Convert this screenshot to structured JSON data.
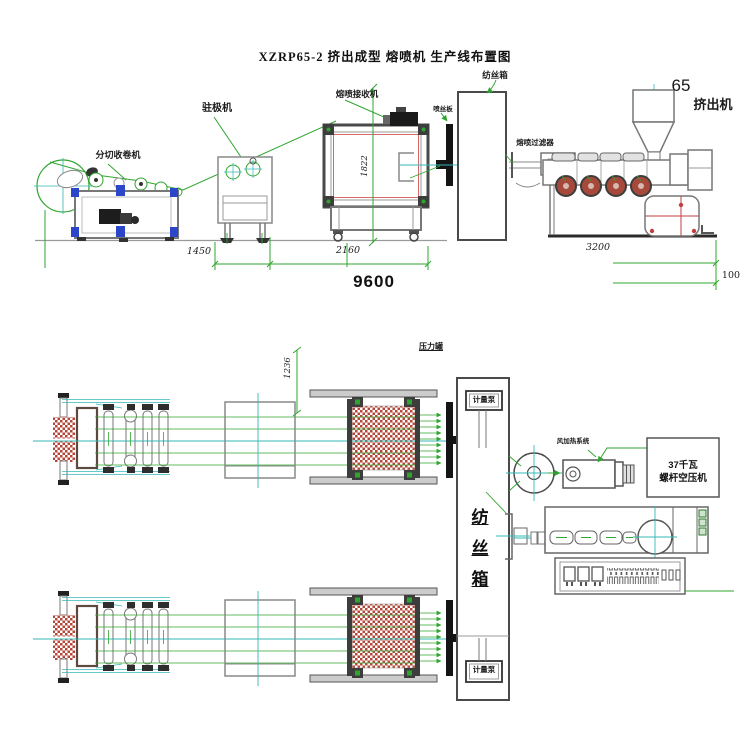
{
  "title": "XZRP65-2 挤出成型 熔喷机 生产线布置图",
  "colors": {
    "line_green": "#2fa52f",
    "centerline_cyan": "#35b8b8",
    "mesh_red": "#b5473a",
    "accent_blue": "#2b46c8"
  },
  "elevation_view": {
    "machine_labels": {
      "slitter_winder": "分切收卷机",
      "electret_machine": "驻极机",
      "meltblown_receiver": "熔喷接收机",
      "spinneret": "喷丝板",
      "spinning_box": "纺丝箱",
      "melt_filter": "熔喷过滤器",
      "extruder_model": "65",
      "extruder": "挤出机"
    },
    "dimensions": {
      "receiver_height": "1822",
      "slitter_to_electret": "1450",
      "electret_to_receiver": "2160",
      "total_length": "9600",
      "extruder_length": "3200",
      "clearance": "100"
    }
  },
  "plan_view": {
    "labels": {
      "pressure_tank": "压力罐",
      "metering_pump_upper": "计量泵",
      "metering_pump_lower": "计量泵",
      "spinning_box_chars": [
        "纺",
        "丝",
        "箱"
      ],
      "air_heating_system": "风加热系统",
      "compressor_power": "37千瓦",
      "compressor_name": "螺杆空压机"
    },
    "dimensions": {
      "offset_height": "1236"
    }
  }
}
